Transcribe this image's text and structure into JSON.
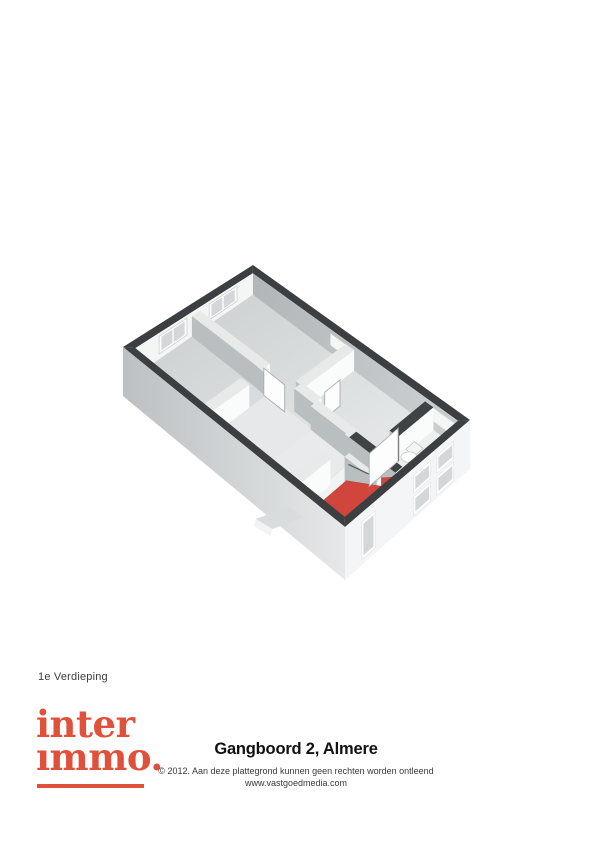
{
  "floor_label": "1e Verdieping",
  "logo": {
    "line1": "inter",
    "line2": "ımmo.",
    "color": "#e0513c"
  },
  "footer": {
    "title": "Gangboord 2, Almere",
    "copyright": "© 2012. Aan deze plattegrond kunnen geen rechten worden ontleend",
    "website": "www.vastgoedmedia.com"
  },
  "floorplan": {
    "corners": {
      "T": [
        253,
        265
      ],
      "L": [
        123,
        347
      ],
      "R": [
        470,
        420
      ],
      "B": [
        345,
        527
      ]
    },
    "thickness": {
      "tu": 0.048,
      "tv": 0.028
    },
    "heights": {
      "interior_base": 21,
      "interior_slope": 13,
      "wall_top_frac": 0.16,
      "exterior_base": 45,
      "exterior_slope": 8
    },
    "colors": {
      "band": "#3b3f42",
      "band_dark_top": "#3f4346",
      "floor_grad_a": "#c9cdce",
      "floor_grad_b": "#eff1f1",
      "hall_floor": "#e6e8e9",
      "landing_floor": "#e8eaeb",
      "stair_landing_floor": "#f1f3f3",
      "bath_floor": "#edefef",
      "face_gray_a": "#b0b5b7",
      "face_gray_b": "#c9cdcf",
      "wall_gray": "#b9bec0",
      "wall_white": "#fafbfb",
      "wall_top": "#e8eaea",
      "inner_end_face": "#f4f6f6",
      "glass": "#d4d7d8",
      "frame": "#ffffff",
      "frame_stroke": "#c5c9ca",
      "stairs_red": "#d0453c",
      "stairs_red_edge": "#b23a33",
      "ext_side_a": "#bcc0c2",
      "ext_side_b": "#e6e8e9",
      "ext_end": "#f4f5f6",
      "door_fill": "#fdfdfd",
      "door_stroke": "#a8adaf",
      "jamb_dark": "#4a4e50",
      "railing": "#55595b",
      "fixture_stroke": "#c2c6c7"
    },
    "floors": [
      {
        "u": [
          0.048,
          0.952
        ],
        "v": [
          0.028,
          0.972
        ],
        "fill": "grad:floor",
        "name": "floor-base"
      },
      {
        "u": [
          0.504,
          0.952
        ],
        "v": [
          0.364,
          0.565
        ],
        "fill": "#e6e8e9",
        "name": "floor-hallway"
      },
      {
        "u": [
          0.5,
          0.952
        ],
        "v": [
          0.565,
          0.745
        ],
        "fill": "#e8eaeb",
        "name": "floor-landing"
      },
      {
        "u": [
          0.5,
          0.952
        ],
        "v": [
          0.75,
          0.795
        ],
        "fill": "#f1f3f3",
        "name": "floor-stair-landing"
      },
      {
        "u": [
          0.048,
          0.455
        ],
        "v": [
          0.855,
          0.972
        ],
        "fill": "#edefef",
        "name": "floor-bathroom"
      }
    ],
    "walls": [
      {
        "name": "wall-bedroom-divider",
        "o": "V",
        "pos": 0.485,
        "t": 0.032,
        "span": [
          0.028,
          0.345
        ],
        "top": "light"
      },
      {
        "name": "wall-hall-north",
        "o": "U",
        "pos": 0.345,
        "t": 0.019,
        "span": [
          0.485,
          0.952
        ],
        "gaps": [
          [
            0.52,
            0.645
          ]
        ],
        "top": "light"
      },
      {
        "name": "wall-roomA-south",
        "o": "U",
        "pos": 0.475,
        "t": 0.019,
        "span": [
          0.048,
          0.44
        ],
        "top": "light"
      },
      {
        "name": "wall-hall-stub",
        "o": "V",
        "pos": 0.455,
        "t": 0.03,
        "span": [
          0.475,
          0.565
        ],
        "top": "light"
      },
      {
        "name": "wall-landing-west",
        "o": "V",
        "pos": 0.48,
        "t": 0.03,
        "span": [
          0.565,
          0.745
        ],
        "top": "light"
      },
      {
        "name": "wall-stairhead",
        "o": "U",
        "pos": 0.745,
        "t": 0.019,
        "span": [
          0.49,
          0.952
        ],
        "gaps": [
          [
            0.52,
            0.7
          ]
        ],
        "top": "light"
      },
      {
        "name": "wall-stairwell-side",
        "o": "V",
        "pos": 0.49,
        "t": 0.028,
        "span": [
          0.745,
          0.955
        ],
        "top": "dark"
      },
      {
        "name": "wall-bathroom",
        "o": "U",
        "pos": 0.84,
        "t": 0.019,
        "span": [
          0.048,
          0.33
        ],
        "top": "dark"
      }
    ],
    "thin_wall": {
      "name": "wall-stair-split",
      "o": "V",
      "pos": 0.615,
      "t": 0.018,
      "span": [
        0.79,
        0.935
      ],
      "top": "light"
    },
    "stairs": [
      {
        "name": "stairs-lower-flight",
        "pts": [
          [
            0.51,
            0.845,
            1
          ],
          [
            0.6,
            0.845,
            1
          ],
          [
            0.6,
            0.935,
            0.45
          ],
          [
            0.51,
            0.935,
            0.45
          ]
        ]
      },
      {
        "name": "stairs-upper-flight",
        "pts": [
          [
            0.62,
            0.79,
            1
          ],
          [
            0.935,
            0.79,
            1
          ],
          [
            0.935,
            0.955,
            0.25
          ],
          [
            0.62,
            0.955,
            0.25
          ]
        ]
      }
    ],
    "end_wall_windows": [
      {
        "u": [
          0.17,
          0.385
        ]
      },
      {
        "u": [
          0.555,
          0.77
        ]
      }
    ],
    "long_wall_window_strips": [
      {
        "v": [
          0.385,
          0.455
        ]
      },
      {
        "v": [
          0.84,
          0.96
        ]
      }
    ],
    "hall_window_sill": {
      "v": [
        0.44,
        0.58
      ]
    },
    "ext_end_windows": [
      {
        "s": [
          0.13,
          0.265
        ],
        "z": [
          0.14,
          0.5
        ]
      },
      {
        "s": [
          0.13,
          0.265
        ],
        "z": [
          0.56,
          0.94
        ]
      },
      {
        "s": [
          0.315,
          0.45
        ],
        "z": [
          0.14,
          0.5
        ]
      },
      {
        "s": [
          0.315,
          0.45
        ],
        "z": [
          0.56,
          0.94
        ]
      },
      {
        "s": [
          0.76,
          0.865
        ],
        "z": [
          0.18,
          0.9
        ]
      }
    ],
    "doors": [
      {
        "name": "door-bedroom2",
        "base": [
          [
            0.525,
            0.36
          ],
          [
            0.525,
            0.455
          ]
        ],
        "h": 27
      },
      {
        "name": "door-room-east",
        "base": [
          [
            0.4,
            0.565
          ],
          [
            0.28,
            0.565
          ]
        ],
        "h": 26
      },
      {
        "name": "door-bathroom-open",
        "base": [
          [
            0.33,
            0.86
          ],
          [
            0.56,
            0.86
          ]
        ],
        "h": 33
      }
    ],
    "fixture": {
      "center": [
        0.27,
        0.875
      ],
      "rx": 8,
      "ry": 5.2,
      "tank": [
        [
          0.175,
          0.845
        ],
        [
          0.245,
          0.885
        ]
      ]
    },
    "canopy": {
      "anchor": [
        1,
        0.8
      ],
      "top": [
        [
          -12,
          16
        ],
        [
          -45,
          28
        ],
        [
          -28,
          38
        ],
        [
          3,
          26
        ]
      ],
      "side": [
        [
          -45,
          28
        ],
        [
          -28,
          38
        ],
        [
          -30,
          45
        ],
        [
          -47,
          35
        ]
      ]
    }
  }
}
